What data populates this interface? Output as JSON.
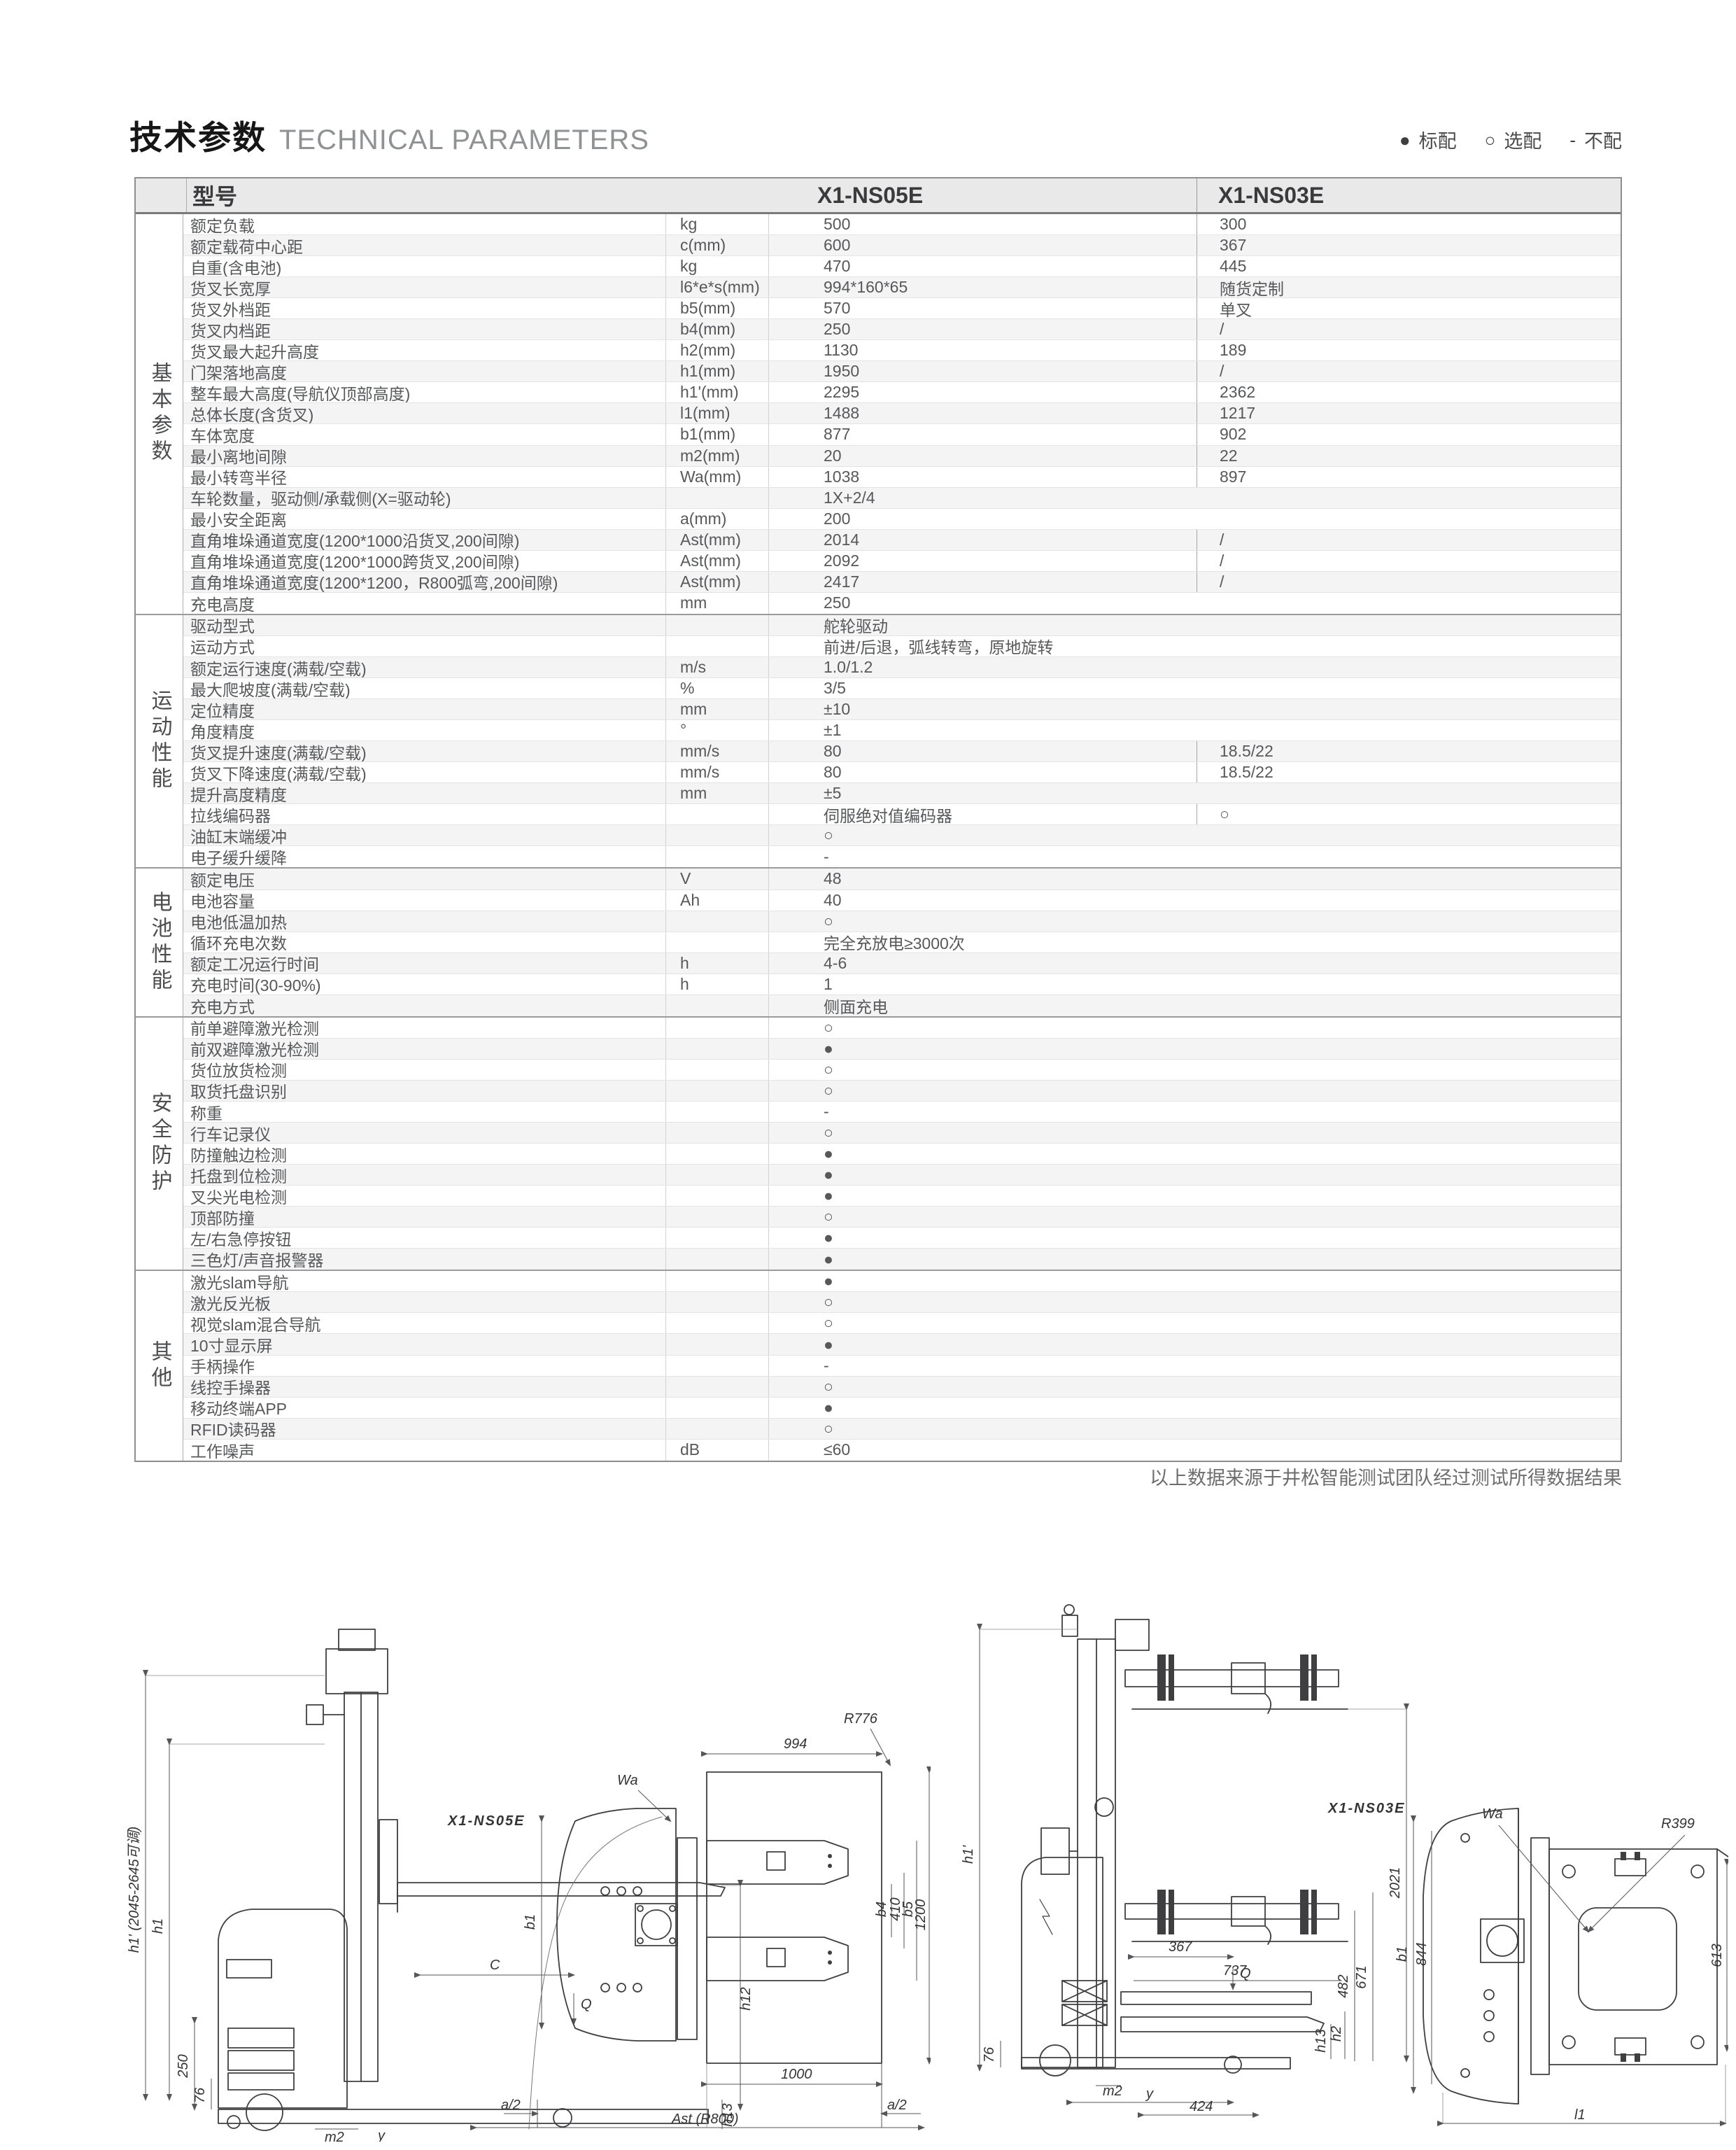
{
  "page": {
    "title_zh": "技术参数",
    "title_en": "TECHNICAL PARAMETERS",
    "legend": [
      {
        "symbol": "●",
        "label": "标配"
      },
      {
        "symbol": "○",
        "label": "选配"
      },
      {
        "symbol": "-",
        "label": "不配"
      }
    ],
    "footnote": "以上数据来源于井松智能测试团队经过测试所得数据结果"
  },
  "table": {
    "header": {
      "model_label": "型号",
      "col1": "X1-NS05E",
      "col2": "X1-NS03E"
    },
    "sections": [
      {
        "name": "基本参数",
        "rows": [
          {
            "param": "额定负载",
            "unit": "kg",
            "v1": "500",
            "v2": "300"
          },
          {
            "param": "额定载荷中心距",
            "unit": "c(mm)",
            "v1": "600",
            "v2": "367"
          },
          {
            "param": "自重(含电池)",
            "unit": "kg",
            "v1": "470",
            "v2": "445"
          },
          {
            "param": "货叉长宽厚",
            "unit": "l6*e*s(mm)",
            "v1": "994*160*65",
            "v2": "随货定制"
          },
          {
            "param": "货叉外档距",
            "unit": "b5(mm)",
            "v1": "570",
            "v2": "单叉"
          },
          {
            "param": "货叉内档距",
            "unit": "b4(mm)",
            "v1": "250",
            "v2": "/"
          },
          {
            "param": "货叉最大起升高度",
            "unit": "h2(mm)",
            "v1": "1130",
            "v2": "189"
          },
          {
            "param": "门架落地高度",
            "unit": "h1(mm)",
            "v1": "1950",
            "v2": "/"
          },
          {
            "param": "整车最大高度(导航仪顶部高度)",
            "unit": "h1'(mm)",
            "v1": "2295",
            "v2": "2362"
          },
          {
            "param": "总体长度(含货叉)",
            "unit": "l1(mm)",
            "v1": "1488",
            "v2": "1217"
          },
          {
            "param": "车体宽度",
            "unit": "b1(mm)",
            "v1": "877",
            "v2": "902"
          },
          {
            "param": "最小离地间隙",
            "unit": "m2(mm)",
            "v1": "20",
            "v2": "22"
          },
          {
            "param": "最小转弯半径",
            "unit": "Wa(mm)",
            "v1": "1038",
            "v2": "897"
          },
          {
            "param": "车轮数量，驱动侧/承载侧(X=驱动轮)",
            "unit": "",
            "v1": "1X+2/4",
            "v2": ""
          },
          {
            "param": "最小安全距离",
            "unit": "a(mm)",
            "v1": "200",
            "v2": ""
          },
          {
            "param": "直角堆垛通道宽度(1200*1000沿货叉,200间隙)",
            "unit": "Ast(mm)",
            "v1": "2014",
            "v2": "/"
          },
          {
            "param": "直角堆垛通道宽度(1200*1000跨货叉,200间隙)",
            "unit": "Ast(mm)",
            "v1": "2092",
            "v2": "/"
          },
          {
            "param": "直角堆垛通道宽度(1200*1200，R800弧弯,200间隙)",
            "unit": "Ast(mm)",
            "v1": "2417",
            "v2": "/"
          },
          {
            "param": "充电高度",
            "unit": "mm",
            "v1": "250",
            "v2": ""
          }
        ]
      },
      {
        "name": "运动性能",
        "rows": [
          {
            "param": "驱动型式",
            "unit": "",
            "v1": "舵轮驱动",
            "v2": ""
          },
          {
            "param": "运动方式",
            "unit": "",
            "v1": "前进/后退，弧线转弯，原地旋转",
            "v2": ""
          },
          {
            "param": "额定运行速度(满载/空载)",
            "unit": "m/s",
            "v1": "1.0/1.2",
            "v2": ""
          },
          {
            "param": "最大爬坡度(满载/空载)",
            "unit": "%",
            "v1": "3/5",
            "v2": ""
          },
          {
            "param": "定位精度",
            "unit": "mm",
            "v1": "±10",
            "v2": ""
          },
          {
            "param": "角度精度",
            "unit": "°",
            "v1": "±1",
            "v2": ""
          },
          {
            "param": "货叉提升速度(满载/空载)",
            "unit": "mm/s",
            "v1": "80",
            "v2": "18.5/22"
          },
          {
            "param": "货叉下降速度(满载/空载)",
            "unit": "mm/s",
            "v1": "80",
            "v2": "18.5/22"
          },
          {
            "param": "提升高度精度",
            "unit": "mm",
            "v1": "±5",
            "v2": ""
          },
          {
            "param": "拉线编码器",
            "unit": "",
            "v1": "伺服绝对值编码器",
            "v2": "○"
          },
          {
            "param": "油缸末端缓冲",
            "unit": "",
            "v1": "○",
            "v2": ""
          },
          {
            "param": "电子缓升缓降",
            "unit": "",
            "v1": "-",
            "v2": ""
          }
        ]
      },
      {
        "name": "电池性能",
        "rows": [
          {
            "param": "额定电压",
            "unit": "V",
            "v1": "48",
            "v2": ""
          },
          {
            "param": "电池容量",
            "unit": "Ah",
            "v1": "40",
            "v2": ""
          },
          {
            "param": "电池低温加热",
            "unit": "",
            "v1": "○",
            "v2": ""
          },
          {
            "param": "循环充电次数",
            "unit": "",
            "v1": "完全充放电≥3000次",
            "v2": ""
          },
          {
            "param": "额定工况运行时间",
            "unit": "h",
            "v1": "4-6",
            "v2": ""
          },
          {
            "param": "充电时间(30-90%)",
            "unit": "h",
            "v1": "1",
            "v2": ""
          },
          {
            "param": "充电方式",
            "unit": "",
            "v1": "侧面充电",
            "v2": ""
          }
        ]
      },
      {
        "name": "安全防护",
        "rows": [
          {
            "param": "前单避障激光检测",
            "unit": "",
            "v1": "○",
            "v2": ""
          },
          {
            "param": "前双避障激光检测",
            "unit": "",
            "v1": "●",
            "v2": ""
          },
          {
            "param": "货位放货检测",
            "unit": "",
            "v1": "○",
            "v2": ""
          },
          {
            "param": "取货托盘识别",
            "unit": "",
            "v1": "○",
            "v2": ""
          },
          {
            "param": "称重",
            "unit": "",
            "v1": "-",
            "v2": ""
          },
          {
            "param": "行车记录仪",
            "unit": "",
            "v1": "○",
            "v2": ""
          },
          {
            "param": "防撞触边检测",
            "unit": "",
            "v1": "●",
            "v2": ""
          },
          {
            "param": "托盘到位检测",
            "unit": "",
            "v1": "●",
            "v2": ""
          },
          {
            "param": "叉尖光电检测",
            "unit": "",
            "v1": "●",
            "v2": ""
          },
          {
            "param": "顶部防撞",
            "unit": "",
            "v1": "○",
            "v2": ""
          },
          {
            "param": "左/右急停按钮",
            "unit": "",
            "v1": "●",
            "v2": ""
          },
          {
            "param": "三色灯/声音报警器",
            "unit": "",
            "v1": "●",
            "v2": ""
          }
        ]
      },
      {
        "name": "其他",
        "rows": [
          {
            "param": "激光slam导航",
            "unit": "",
            "v1": "●",
            "v2": ""
          },
          {
            "param": "激光反光板",
            "unit": "",
            "v1": "○",
            "v2": ""
          },
          {
            "param": "视觉slam混合导航",
            "unit": "",
            "v1": "○",
            "v2": ""
          },
          {
            "param": "10寸显示屏",
            "unit": "",
            "v1": "●",
            "v2": ""
          },
          {
            "param": "手柄操作",
            "unit": "",
            "v1": "-",
            "v2": ""
          },
          {
            "param": "线控手操器",
            "unit": "",
            "v1": "○",
            "v2": ""
          },
          {
            "param": "移动终端APP",
            "unit": "",
            "v1": "●",
            "v2": ""
          },
          {
            "param": "RFID读码器",
            "unit": "",
            "v1": "○",
            "v2": ""
          },
          {
            "param": "工作噪声",
            "unit": "dB",
            "v1": "≤60",
            "v2": ""
          }
        ]
      }
    ]
  },
  "drawings": {
    "left": {
      "model_label": "X1-NS05E",
      "dims": [
        "h1' (2045-2645可调)",
        "h1",
        "250",
        "76",
        "m2",
        "y",
        "l1",
        "C",
        "Q",
        "h12",
        "h13",
        "Wa",
        "b1",
        "994",
        "R776",
        "b4",
        "410",
        "b5",
        "1200",
        "1000",
        "a/2",
        "a/2",
        "Ast (R800)"
      ]
    },
    "right": {
      "model_label": "X1-NS03E",
      "dims": [
        "h1'",
        "2021",
        "367",
        "Q",
        "737",
        "482",
        "671",
        "h13",
        "h2",
        "76",
        "m2",
        "y",
        "424",
        "Wa",
        "b1",
        "844",
        "R399",
        "613",
        "l1"
      ]
    }
  }
}
